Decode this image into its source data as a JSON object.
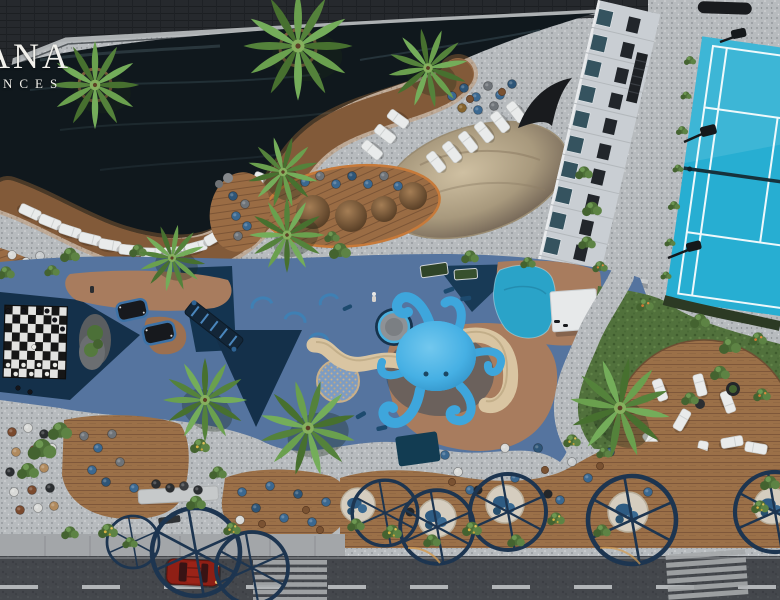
{
  "brand": {
    "line1": "ANA",
    "line2": "ENCES"
  },
  "palette": {
    "pool_water": "#10181d",
    "deck_wood": "#946844",
    "terrazzo": "#b7bbbe",
    "lounger_white": "#e9ebeb",
    "sand": "#c4b294",
    "playground_blue": "#55749f",
    "playground_navy": "#14304a",
    "playground_tan": "#a87c5e",
    "octopus_blue": "#46b0e4",
    "slide_tan": "#d9c5a2",
    "court_blue": "#27aed2",
    "court_line": "#ffffff",
    "building_white": "#c9ced3",
    "grass_green": "#51713c",
    "ring_navy": "#1d3550",
    "street_asphalt": "#44474c",
    "sidewalk": "#a3a6a9",
    "car_red": "#8f1f15",
    "logo_white": "#f2f1ec",
    "glow_orange": "#c8803e",
    "pouf_blue": "#3b6890",
    "mosaic_blue": "#7d9cc2",
    "thatch_brown": "#8a6a48",
    "splash_blue": "#2aa3c8"
  }
}
